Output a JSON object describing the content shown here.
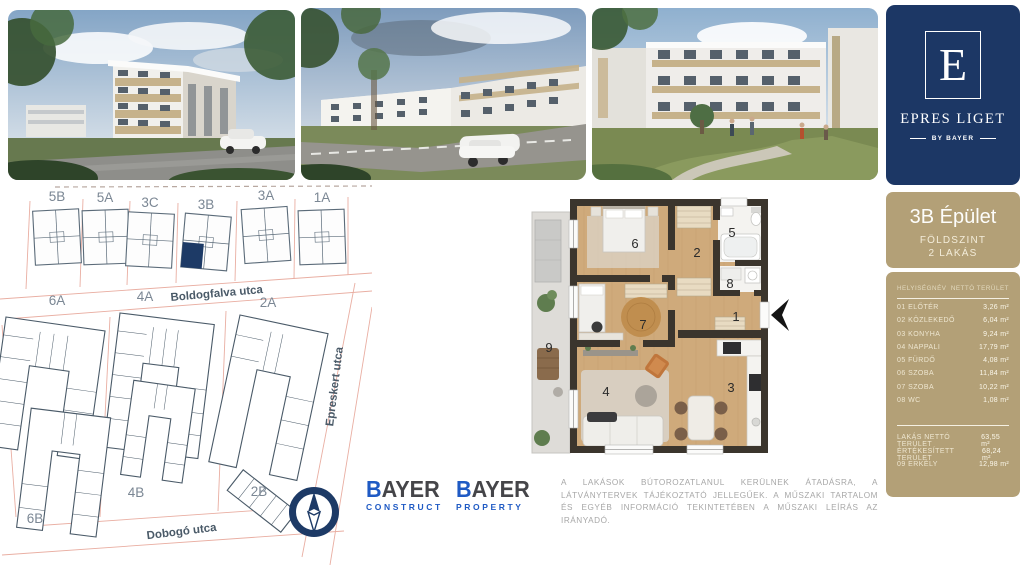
{
  "brand": {
    "letter": "E",
    "name": "EPRES LIGET",
    "byline": "BY BAYER"
  },
  "unit_panel": {
    "title": "3B Épület",
    "floor": "FÖLDSZINT",
    "units": "2 LAKÁS",
    "columns": {
      "name": "HELYISÉGNÉV",
      "area": "NETTÓ TERÜLET"
    },
    "rows": [
      {
        "label": "01 ELŐTÉR",
        "area": "3,26 m²"
      },
      {
        "label": "02 KÖZLEKEDŐ",
        "area": "6,04 m²"
      },
      {
        "label": "03 KONYHA",
        "area": "9,24 m²"
      },
      {
        "label": "04 NAPPALI",
        "area": "17,79 m²"
      },
      {
        "label": "05 FÜRDŐ",
        "area": "4,08 m²"
      },
      {
        "label": "06 SZOBA",
        "area": "11,84 m²"
      },
      {
        "label": "07 SZOBA",
        "area": "10,22 m²"
      },
      {
        "label": "08 WC",
        "area": "1,08 m²"
      }
    ],
    "summary": [
      {
        "label": "LAKÁS NETTÓ TERÜLET",
        "area": "63,55 m²"
      },
      {
        "label": "ÉRTÉKESÍTETT TERÜLET",
        "area": "68,24 m²"
      },
      {
        "label": "09 ERKÉLY",
        "area": "12,98 m²"
      }
    ]
  },
  "site_plan": {
    "top_row": [
      "5B",
      "5A",
      "3C",
      "3B",
      "3A",
      "1A"
    ],
    "mid_row": [
      "6A",
      "4A",
      "2A"
    ],
    "bottom_row": [
      "6B",
      "4B",
      "2B"
    ],
    "streets": {
      "north": "Boldogfalva utca",
      "east": "Epreskert utca",
      "south": "Dobogó utca"
    },
    "highlighted": "3B"
  },
  "floor_plan": {
    "rooms": [
      "1",
      "2",
      "3",
      "4",
      "5",
      "6",
      "7",
      "8",
      "9"
    ]
  },
  "footer": {
    "logo1": {
      "initial": "B",
      "rest": "AYER",
      "sub": "CONSTRUCT"
    },
    "logo2": {
      "initial": "B",
      "rest": "AYER",
      "sub": "PROPERTY"
    },
    "disclaimer": "A LAKÁSOK BÚTOROZATLANUL KERÜLNEK ÁTADÁSRA, A LÁTVÁNYTERVEK TÁJÉKOZTATÓ JELLEGŰEK. A MŰSZAKI TARTALOM ÉS EGYÉB INFORMÁCIÓ TEKINTETÉBEN A MŰSZAKI LEÍRÁS AZ IRÁNYADÓ."
  },
  "colors": {
    "navy": "#1c3765",
    "gold": "#b3a077",
    "accent_blue": "#1f5ac4",
    "parcel_red": "#e9aea2",
    "wall": "#3b352d",
    "wood": "#cfaa7b"
  }
}
